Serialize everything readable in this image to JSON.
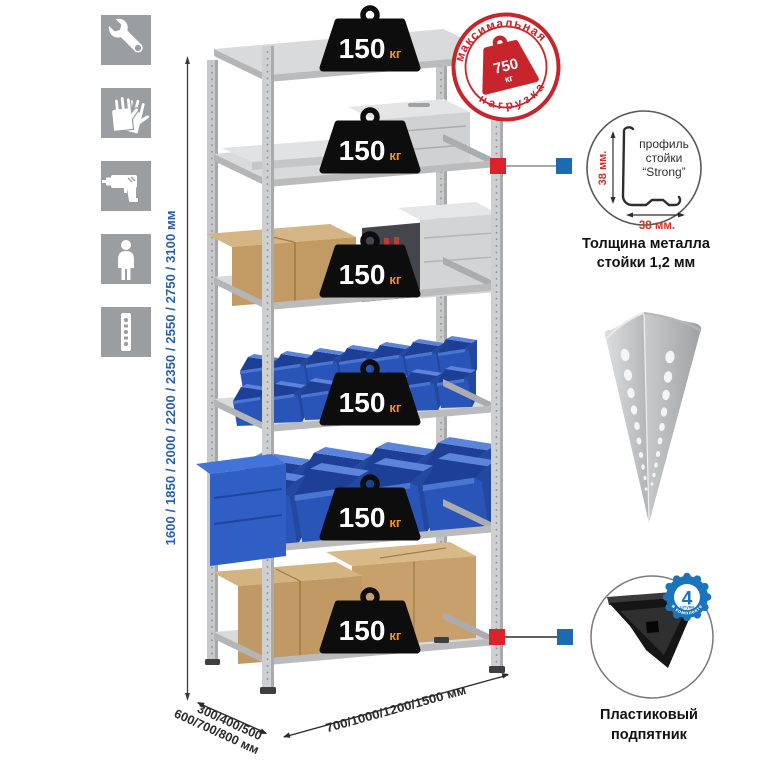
{
  "sidebar": {
    "icons": [
      {
        "name": "wrench"
      },
      {
        "name": "gloves"
      },
      {
        "name": "drill"
      },
      {
        "name": "person"
      },
      {
        "name": "rack-post"
      }
    ]
  },
  "height_dimension": {
    "label": "1600 / 1850 / 2000 / 2200 / 2350 / 2550 / 2750 / 3100 мм"
  },
  "rack": {
    "shelves": [
      {
        "load": "150",
        "unit": "кг"
      },
      {
        "load": "150",
        "unit": "кг"
      },
      {
        "load": "150",
        "unit": "кг"
      },
      {
        "load": "150",
        "unit": "кг"
      },
      {
        "load": "150",
        "unit": "кг"
      },
      {
        "load": "150",
        "unit": "кг"
      }
    ]
  },
  "max_load_stamp": {
    "arc_top": "максимальная",
    "arc_bottom": "нагрузка",
    "value": "750",
    "unit": "кг"
  },
  "profile_detail": {
    "label_lines": [
      "профиль",
      "стойки",
      "“Strong”"
    ],
    "vertical_dim": "38 мм.",
    "horizontal_dim": "38 мм.",
    "caption_line1": "Толщина металла",
    "caption_line2": "стойки 1,2 мм"
  },
  "corner_foot": {
    "badge_value": "4",
    "badge_sub": "штуки",
    "badge_arc": "в комплекте",
    "caption_line1": "Пластиковый",
    "caption_line2": "подпятник"
  },
  "depth_dimension": {
    "line1": "300/400/500",
    "line2": "600/700/800 мм"
  },
  "width_dimension": {
    "label": "700/1000/1200/1500 мм"
  },
  "colors": {
    "accent_red": "#d8232a",
    "accent_blue": "#1c69b4",
    "stamp_red": "#c8242c",
    "dim_blue": "#2a5fa8",
    "badge_orange": "#f7941e",
    "bin_blue": "#2a55b8"
  }
}
